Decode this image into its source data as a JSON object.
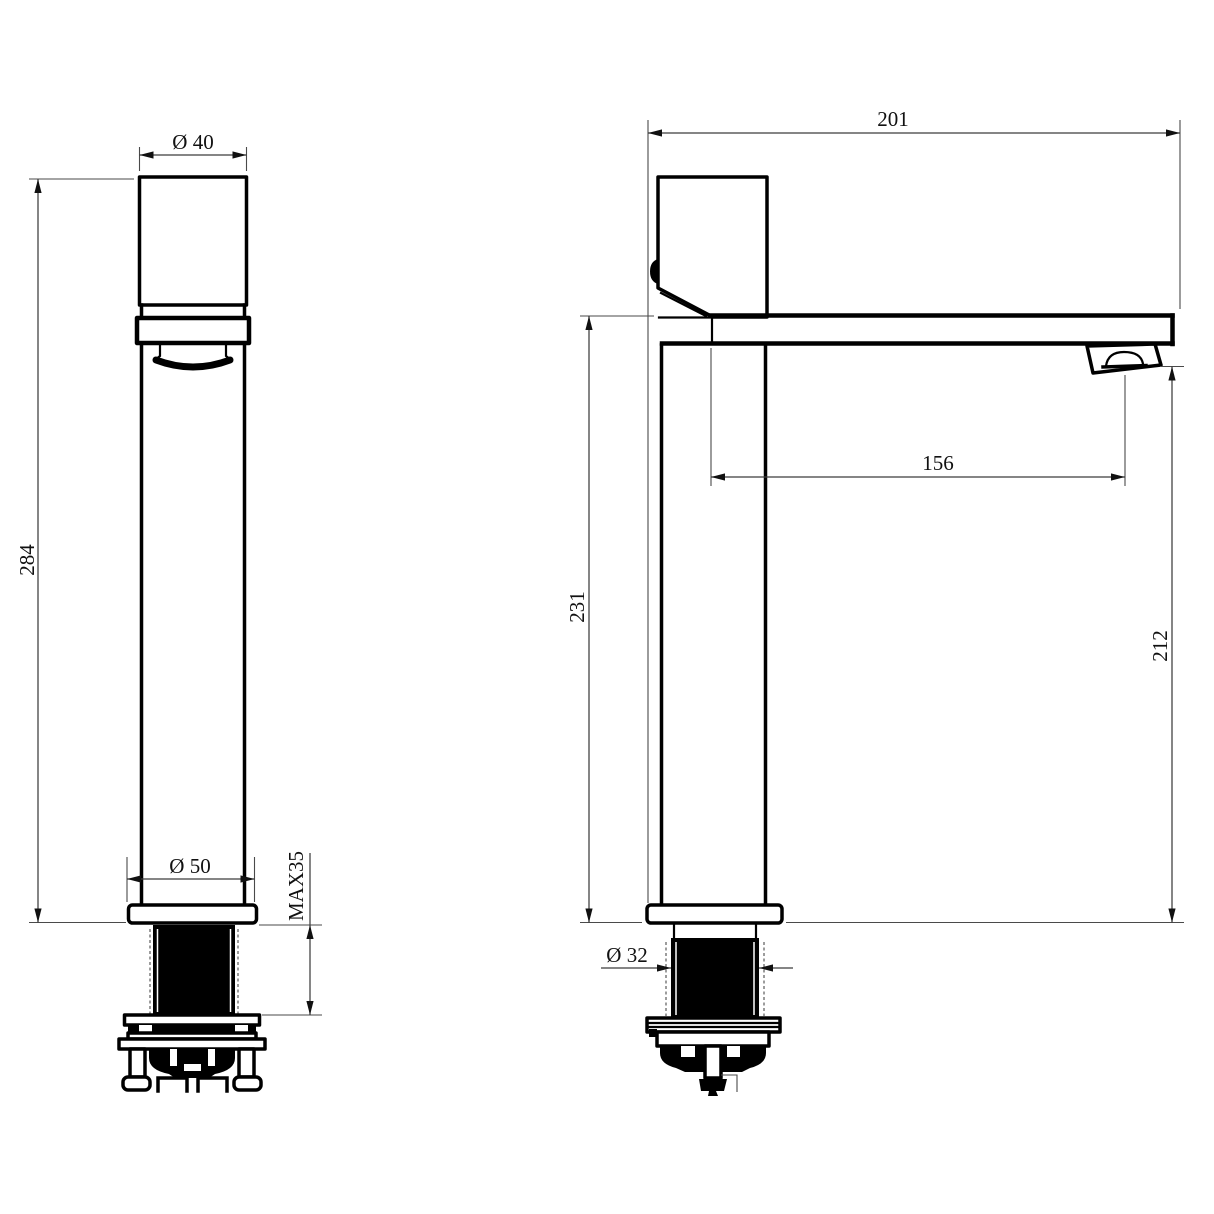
{
  "page": {
    "background": "#ffffff",
    "palette": {
      "outline": "#000000",
      "dimension_lines": "#3c3c3c",
      "text": "#111111"
    }
  },
  "drawing": {
    "type": "technical-dimension-drawing",
    "subject": "tall single-lever basin mixer tap, front and side views",
    "views": {
      "front": {
        "name": "front-view",
        "dims": {
          "top_diameter": {
            "label": "Ø 40",
            "value": 40
          },
          "overall_height": {
            "label": "284",
            "value": 284
          },
          "base_diameter": {
            "label": "Ø 50",
            "value": 50
          },
          "max_deck_thickness": {
            "label": "MAX35",
            "value": 35
          }
        }
      },
      "side": {
        "name": "side-view",
        "dims": {
          "overall_depth": {
            "label": "201",
            "value": 201
          },
          "spout_reach": {
            "label": "156",
            "value": 156
          },
          "spout_height": {
            "label": "231",
            "value": 231
          },
          "outlet_height": {
            "label": "212",
            "value": 212
          },
          "shank_diameter": {
            "label": "Ø 32",
            "value": 32
          }
        }
      }
    }
  }
}
